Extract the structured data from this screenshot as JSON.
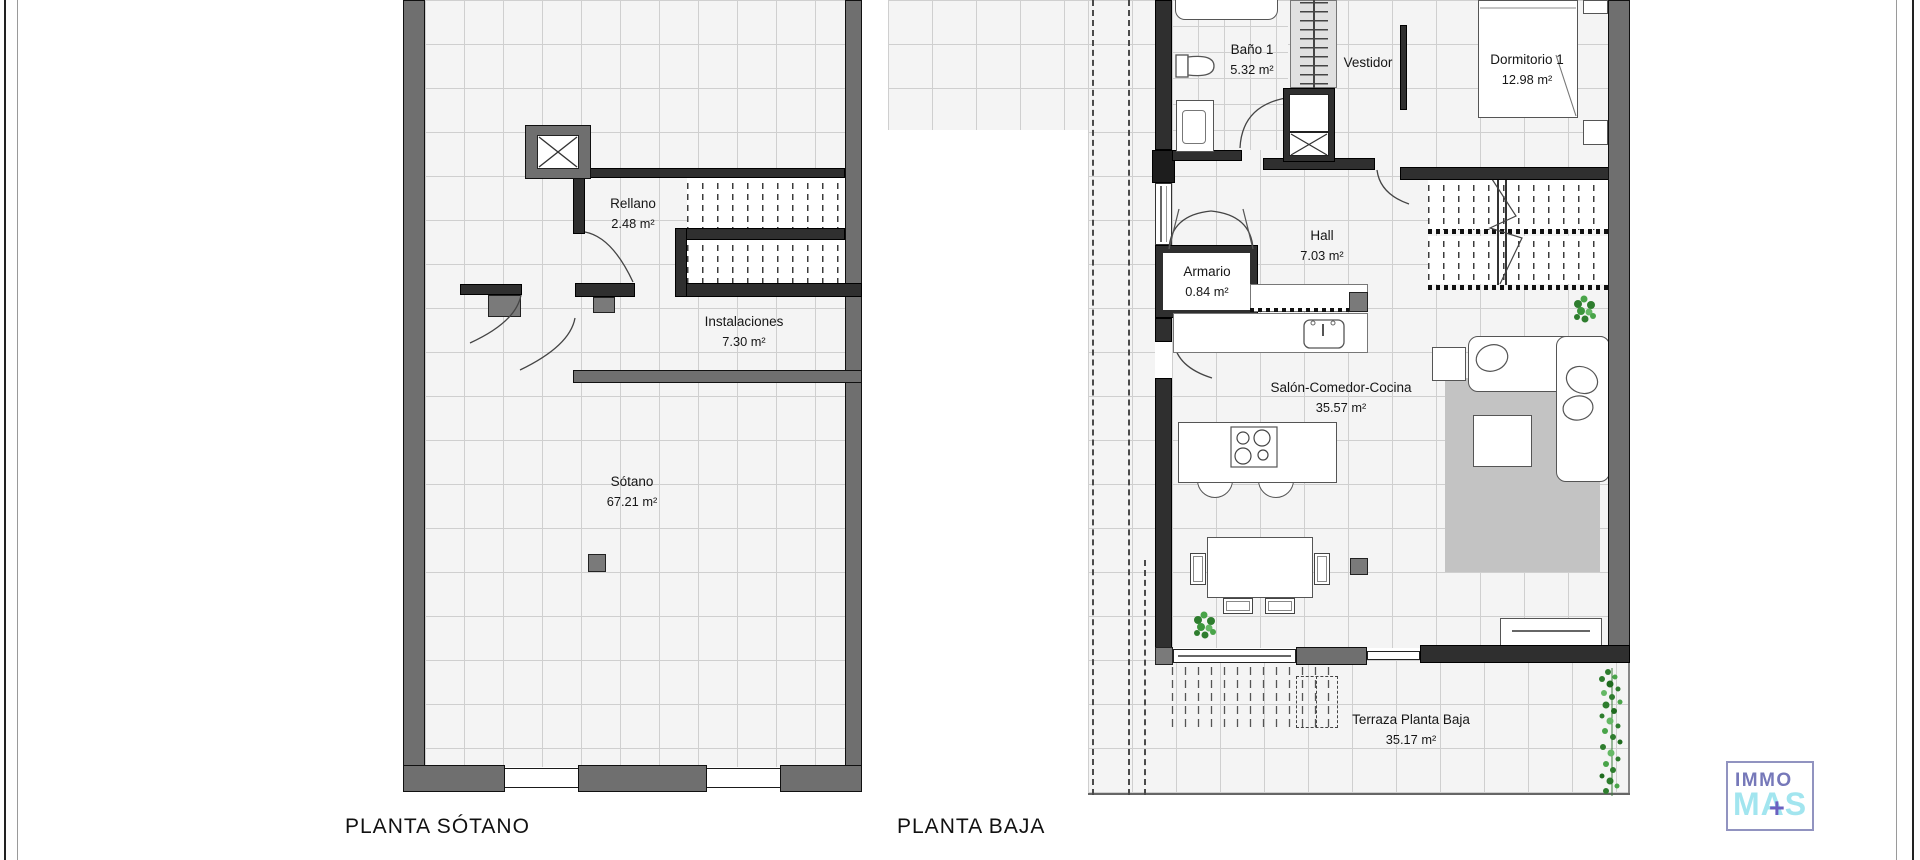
{
  "document": {
    "type": "architectural floor plan"
  },
  "plans": {
    "sotano": {
      "title": "PLANTA SÓTANO",
      "rooms": [
        {
          "name": "Rellano",
          "area": "2.48 m²"
        },
        {
          "name": "Instalaciones",
          "area": "7.30 m²"
        },
        {
          "name": "Sótano",
          "area": "67.21 m²"
        }
      ]
    },
    "baja": {
      "title": "PLANTA BAJA",
      "rooms": [
        {
          "name": "Baño 1",
          "area": "5.32 m²"
        },
        {
          "name": "Vestidor",
          "area": ""
        },
        {
          "name": "Dormitorio 1",
          "area": "12.98 m²"
        },
        {
          "name": "Hall",
          "area": "7.03 m²"
        },
        {
          "name": "Armario",
          "area": "0.84 m²"
        },
        {
          "name": "Salón-Comedor-Cocina",
          "area": "35.57 m²"
        },
        {
          "name": "Terraza Planta Baja",
          "area": "35.17 m²"
        }
      ]
    }
  },
  "logo": {
    "line1": "IMMO",
    "line2": "MAS",
    "plus_glyph": "+"
  },
  "colors": {
    "immo": "#7678b9",
    "mas": "#a2e5ef",
    "plus": "#6b60c0",
    "logo-border": "#9193c0",
    "wall-gray": "#6f6f6f",
    "wall-dark": "#2f2f2f",
    "rug": "#c3c3c3",
    "plant-green": "#2e7d2e"
  }
}
